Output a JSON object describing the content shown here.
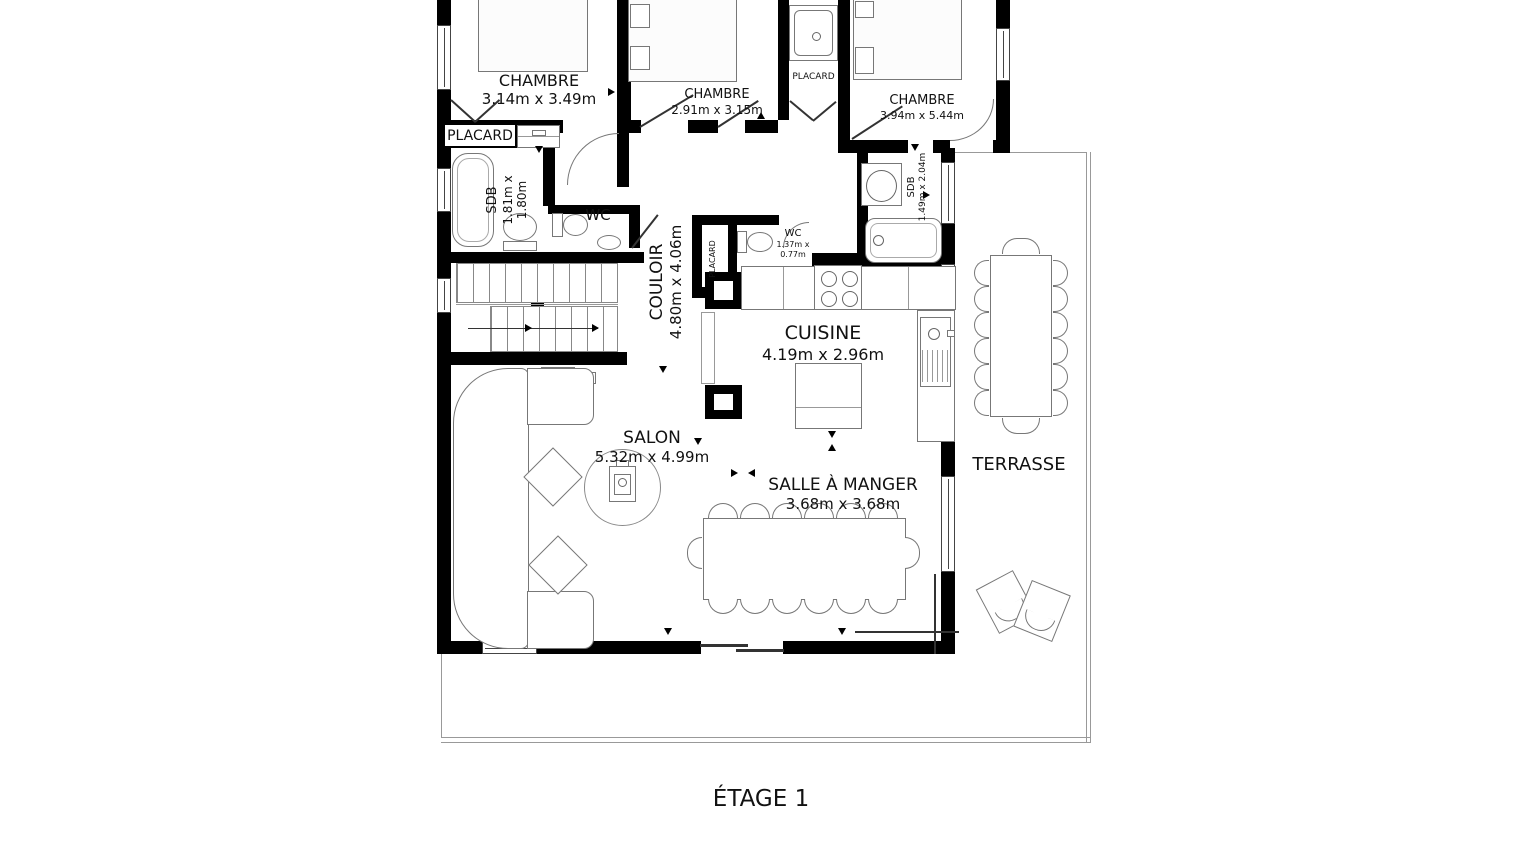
{
  "title": "ÉTAGE 1",
  "colors": {
    "wall": "#000000",
    "furniture_outline": "#777777",
    "thin_line": "#999999",
    "text": "#111111",
    "background": "#ffffff"
  },
  "rooms": {
    "chambre1": {
      "name": "CHAMBRE",
      "dims": "3.14m x 3.49m"
    },
    "chambre2": {
      "name": "CHAMBRE",
      "dims": "2.91m x 3.15m"
    },
    "chambre3": {
      "name": "CHAMBRE",
      "dims": "3.94m x 5.44m"
    },
    "placard_left": {
      "name": "PLACARD"
    },
    "placard_top": {
      "name": "PLACARD"
    },
    "placard_mid": {
      "name": "PLACARD"
    },
    "sdb_left": {
      "name": "SDB",
      "dims_line1": "1.81m x",
      "dims_line2": "1.80m"
    },
    "wc_left": {
      "name": "WC"
    },
    "couloir": {
      "name": "COULOIR",
      "dims": "4.80m x 4.06m"
    },
    "wc_mid": {
      "name": "WC",
      "dims_line1": "1.37m x",
      "dims_line2": "0.77m"
    },
    "sdb_right": {
      "name": "SDB",
      "dims": "1.49m x 2.04m"
    },
    "cuisine": {
      "name": "CUISINE",
      "dims": "4.19m x 2.96m"
    },
    "salon": {
      "name": "SALON",
      "dims": "5.32m x 4.99m"
    },
    "salle_a_manger": {
      "name": "SALLE À MANGER",
      "dims": "3.68m x 3.68m"
    },
    "terrasse": {
      "name": "TERRASSE"
    }
  },
  "icons": {
    "bed": "css-rect-outline",
    "nightstand": "css-rect-outline",
    "bathtub": "css-rounded-rect",
    "toilet": "css-ellipse-plus-tank",
    "shower": "css-nested-squares-drain",
    "sink": "css-ellipse-in-rect",
    "hob": "css-four-circles",
    "kitchen-island": "css-rect-outline",
    "stairs": "css-tread-lines-arrow",
    "sofa": "css-rounded-sections",
    "side-table": "css-rotated-square",
    "wood-stove": "css-rect-circle-on-round-rug",
    "dining-table": "css-rect-outline",
    "chair": "css-semicircle",
    "lounge-chair": "css-rotated-rect-arc",
    "window": "css-double-line",
    "door": "css-quarter-arc"
  }
}
